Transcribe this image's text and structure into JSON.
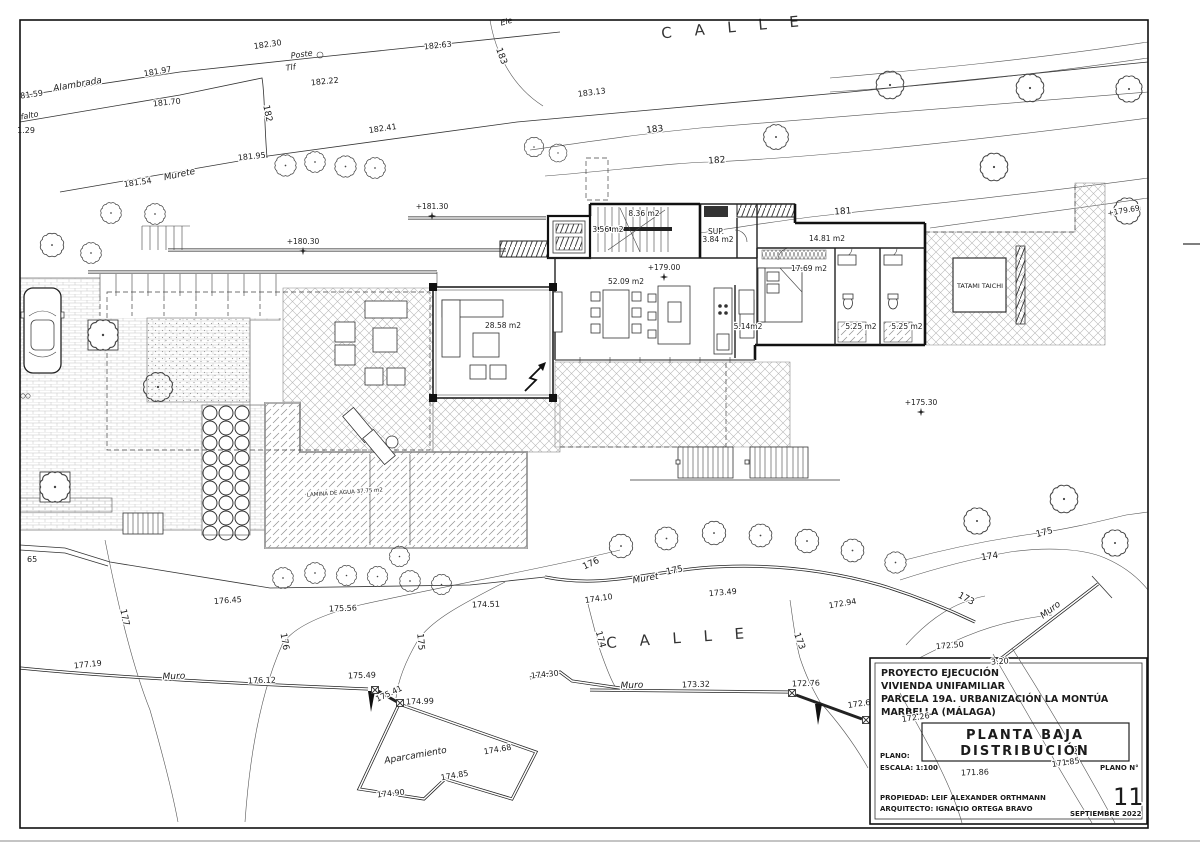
{
  "sheet": {
    "street_top": "C A L L E",
    "street_south": "C A L L E"
  },
  "levels": {
    "l18130": "+181.30",
    "l18030": "+180.30",
    "l17900": "+179.00",
    "l17530": "+175.30",
    "l17969": "+179.69"
  },
  "rooms": {
    "r836": "8.36 m2",
    "r356": "3.56 m2",
    "sup": "SUP.",
    "r384": "3.84 m2",
    "r1481": "14.81 m2",
    "r1769": "17.69 m2",
    "r5209": "52.09 m2",
    "r2858": "28.58 m2",
    "r514": "5.14m2",
    "r525a": "5.25 m2",
    "r525b": "5.25 m2",
    "tatami": "TATAMI TAICHI",
    "lamina": "LAMINA DE AGUA 37.75 m2"
  },
  "site": {
    "alambrada": "Alambrada",
    "asfalto": "falto",
    "poste": "Poste",
    "tlf": "Tlf",
    "ele": "Ele",
    "murete_top": "Murete",
    "murete_south": "Muret",
    "muro_sw": "Muro",
    "muro_s": "Muro",
    "muro_se": "Muro",
    "aparcamiento": "Aparcamiento"
  },
  "contours": {
    "c183v": "183",
    "c183": "183",
    "c182v": "182",
    "c182": "182",
    "c181": "181",
    "c177": "177",
    "c176v": "176",
    "c176": "176",
    "c175v": "175",
    "c175": "175",
    "c175se": "175",
    "c174v": "174",
    "c174se": "174",
    "c173v": "173",
    "c173se": "173"
  },
  "spots": {
    "s18230": "182.30",
    "s18222": "182.22",
    "s18263": "182.63",
    "s18197": "181.97",
    "s18159": "81.59",
    "s18170": "181.70",
    "s129": "1.29",
    "s18313": "183.13",
    "s18241": "182.41",
    "s18195": "181.95",
    "s18154": "181.54",
    "s17719": "177.19",
    "s17645": "176.45",
    "s17612": "176.12",
    "s17556": "175.56",
    "s17549": "175.49",
    "s17541": "175.41",
    "s17499": "174.99",
    "s17451": "174.51",
    "s17430": "174.30",
    "s17468": "174.68",
    "s17485": "174.85",
    "s17490": "174.90",
    "s17410": "174.10",
    "s17349": "173.49",
    "s17332": "173.32",
    "s17294": "172.94",
    "s17276": "172.76",
    "s17269": "172.69",
    "s17250": "172.50",
    "s17226": "172.26",
    "s17186": "171.86",
    "s17185": "171.85",
    "s320": "3.20",
    "s65": "65"
  },
  "title_block": {
    "line1": "PROYECTO EJECUCIÓN",
    "line2": "VIVIENDA UNIFAMILIAR",
    "line3": "PARCELA 19A. URBANIZACIÓN LA MONTÚA",
    "line4": "MARBELLA (MÁLAGA)",
    "plan_title1": "PLANTA BAJA",
    "plan_title2": "DISTRIBUCIÓN",
    "plano": "PLANO:",
    "escala": "ESCALA: 1:100",
    "plano_n": "PLANO N°",
    "number": "11",
    "propiedad": "PROPIEDAD: LEIF ALEXANDER ORTHMANN",
    "arquitecto": "ARQUITECTO: IGNACIO ORTEGA BRAVO",
    "fecha": "SEPTIEMBRE 2022"
  }
}
